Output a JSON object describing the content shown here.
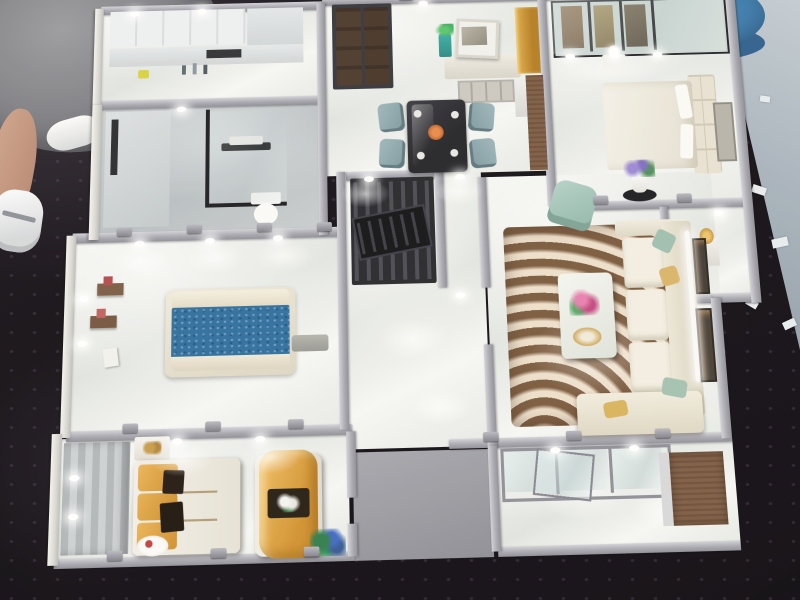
{
  "scene": {
    "type": "photograph",
    "subject": "Top-down photo of a miniature architectural scale model of an apartment interior displayed on a black sequined table",
    "model": {
      "label": "apartment scale model with silver walls, marble floors and LED lighting",
      "wall_color": "#a8a8b0",
      "outer_wall_color": "#e9e8e2",
      "floor_color": "#eef0ec",
      "rooms": [
        {
          "name": "kitchen with white cabinets and counter bottles"
        },
        {
          "name": "bathroom with black glass partition, towel rail and toilet"
        },
        {
          "name": "dining room with dark entry door, sideboard, art frame, gold cabinet and dining set"
        },
        {
          "name": "bedroom with glazed wardrobe, cream bed and flower lamp"
        },
        {
          "name": "display niche with gold ornament"
        },
        {
          "name": "hall with black lattice screen"
        },
        {
          "name": "bedroom with blue bed, cream headboard and wall shelves"
        },
        {
          "name": "hallway with polished marble floor"
        },
        {
          "name": "living room with swirl rug, marble coffee table, cream sectional sofa, teal armchair and flower stand"
        },
        {
          "name": "family room with gold cushion sofa, gold bench and plank accent wall"
        },
        {
          "name": "balcony with glass sliding panels and wood cabinet"
        }
      ]
    },
    "furniture_colors": {
      "blue_bed": "#2d6e9d",
      "gold_cushions": "#dfa045",
      "rug_base": "#a5815d",
      "sofa_cream": "#f1eee2",
      "armchair_teal": "#a5c6bb",
      "lattice_screen": "#26262b",
      "entry_door": "#463429",
      "gold_cabinet": "#c28f2c",
      "flowers_pink": "#d4568e",
      "flowers_purple": "#9b87d4",
      "flowers_blue": "#3f68c8"
    },
    "background": {
      "table_color": "#120e14",
      "table_texture": "black sequined cloth with dot speckles",
      "showroom_floor": "#a8b3bc",
      "paper_scraps": "#e8ecef",
      "stool": {
        "label": "blue round stool",
        "color": "#3f80b2"
      },
      "person": {
        "label": "visitor standing at table edge",
        "details": [
          "grey jacket",
          "bare leg",
          "white sneakers"
        ]
      },
      "chair": {
        "label": "green folding chair",
        "color": "#57a05c"
      }
    }
  }
}
